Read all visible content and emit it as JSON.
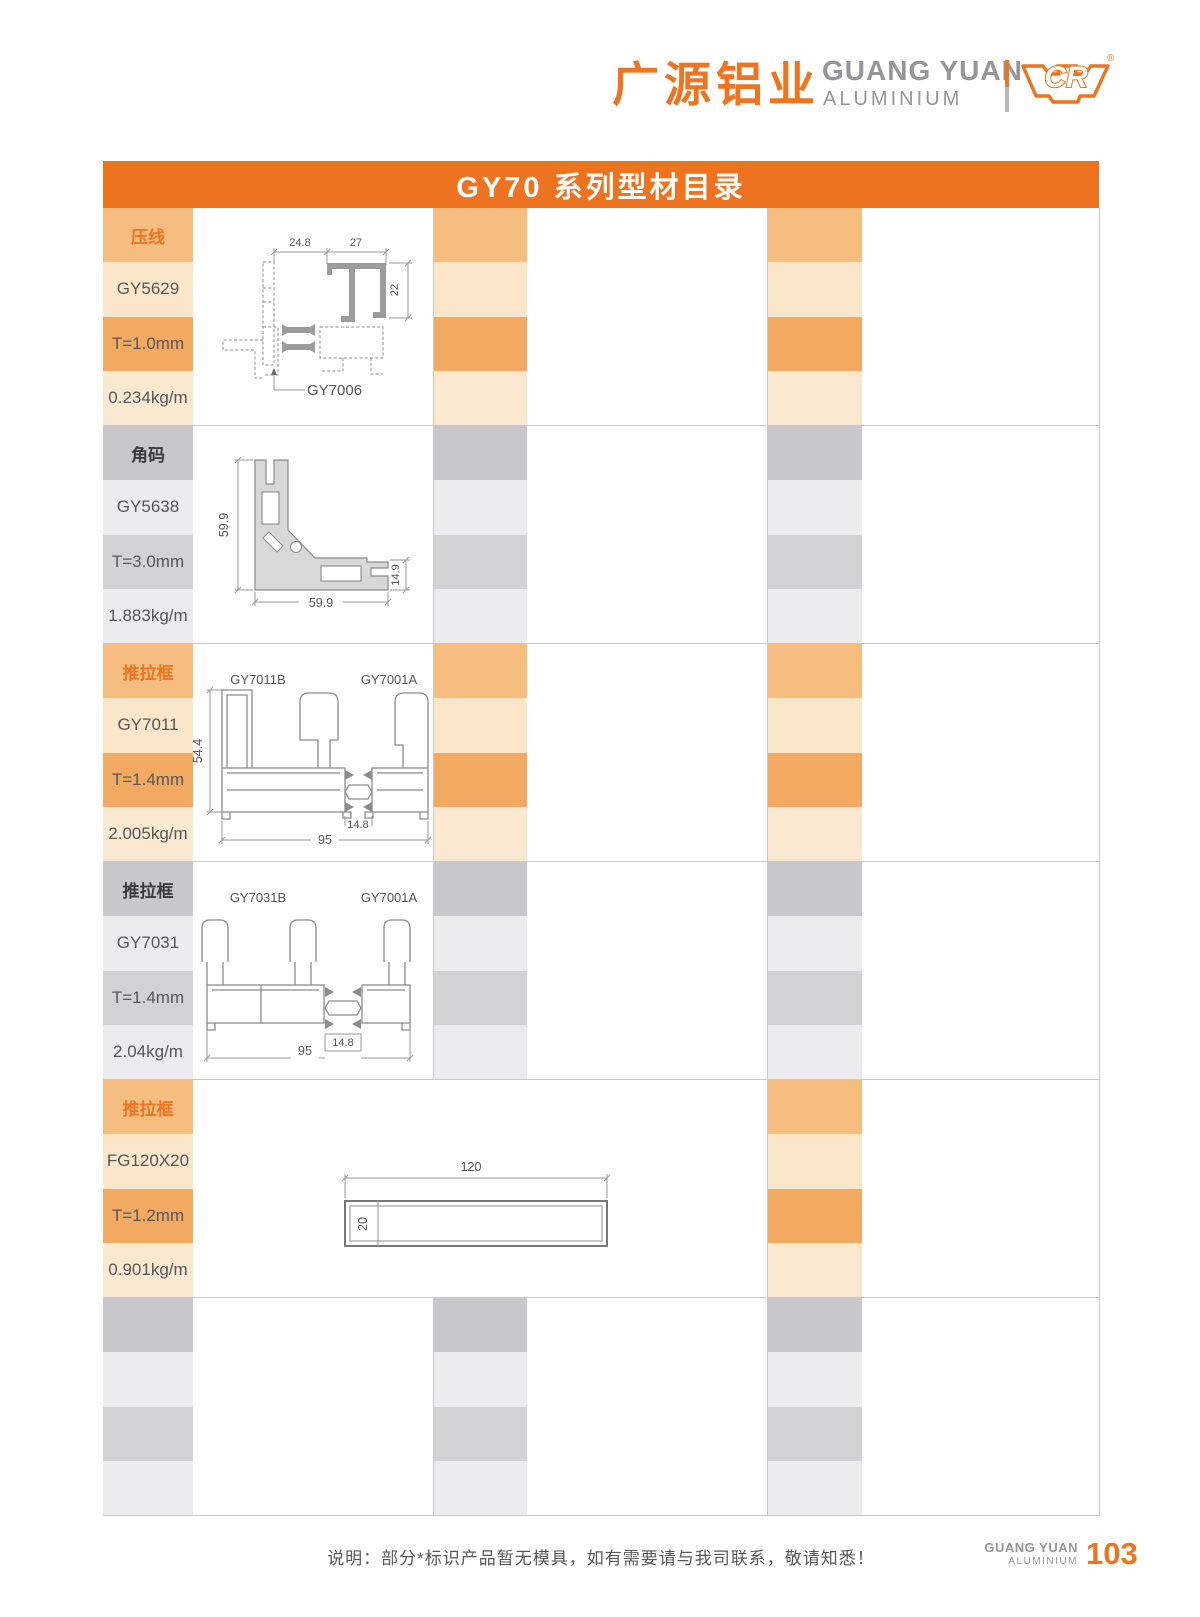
{
  "header": {
    "brand_cn": "广源铝业",
    "brand_en": "GUANG YUAN",
    "brand_sub": "ALUMINIUM",
    "logo_text": "CR",
    "registered": "®"
  },
  "title": "GY70 系列型材目录",
  "colors": {
    "accent": "#ED7420",
    "orange_rows": [
      "#F5BD80",
      "#FCE6CA",
      "#F2A961",
      "#FBE8D1"
    ],
    "gray_rows": [
      "#C8C8CC",
      "#ECECEE",
      "#D2D2D5",
      "#EBEBED"
    ]
  },
  "products": [
    {
      "theme": "orange",
      "category": "压线",
      "model": "GY5629",
      "thickness": "T=1.0mm",
      "weight": "0.234kg/m"
    },
    {
      "theme": "gray",
      "category": "角码",
      "model": "GY5638",
      "thickness": "T=3.0mm",
      "weight": "1.883kg/m"
    },
    {
      "theme": "orange",
      "category": "推拉框",
      "model": "GY7011",
      "thickness": "T=1.4mm",
      "weight": "2.005kg/m"
    },
    {
      "theme": "gray",
      "category": "推拉框",
      "model": "GY7031",
      "thickness": "T=1.4mm",
      "weight": "2.04kg/m"
    },
    {
      "theme": "orange",
      "category": "推拉框",
      "model": "FG120X20",
      "thickness": "T=1.2mm",
      "weight": "0.901kg/m"
    },
    {
      "theme": "gray",
      "category": "",
      "model": "",
      "thickness": "",
      "weight": ""
    }
  ],
  "diagrams": {
    "gy5629": {
      "dim_left": "24.8",
      "dim_right": "27",
      "dim_side": "22",
      "callout": "GY7006"
    },
    "gy5638": {
      "dim_height": "59.9",
      "dim_width": "59.9",
      "dim_end": "14.9"
    },
    "gy7011": {
      "label_left": "GY7011B",
      "label_right": "GY7001A",
      "dim_height": "54.4",
      "dim_interlock": "14.8",
      "dim_width": "95"
    },
    "gy7031": {
      "label_left": "GY7031B",
      "label_right": "GY7001A",
      "dim_interlock": "14.8",
      "dim_width": "95"
    },
    "fg120x20": {
      "dim_width": "120",
      "dim_height": "20"
    }
  },
  "footer": {
    "note": "说明：部分*标识产品暂无模具，如有需要请与我司联系，敬请知悉！",
    "brand_en": "GUANG YUAN",
    "brand_sub": "ALUMINIUM",
    "page": "103"
  }
}
